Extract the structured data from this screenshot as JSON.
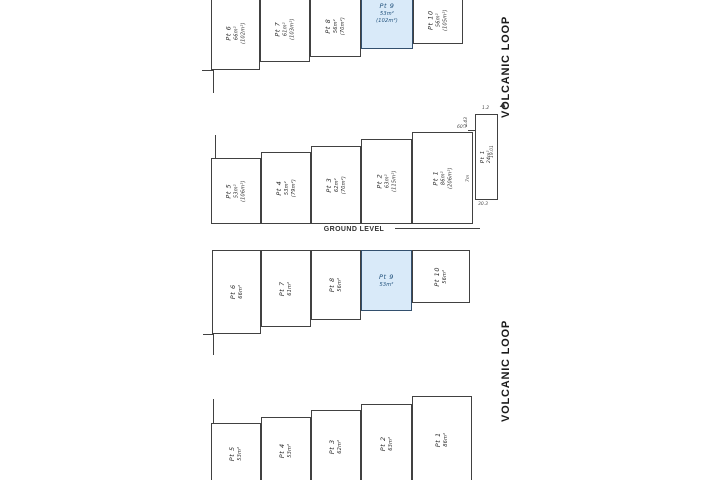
{
  "labels": {
    "street": "VOLCANIC LOOP",
    "ground": "GROUND LEVEL"
  },
  "colors": {
    "highlight_fill": "#d9eaf9",
    "highlight_border": "#33506e",
    "highlight_text": "#1d4e79",
    "line": "#414141"
  },
  "plans": [
    {
      "id": "upper-level-top",
      "lots": [
        {
          "name": "Pt 6",
          "area": "66m²",
          "total": "(102m²)"
        },
        {
          "name": "Pt 7",
          "area": "61m²",
          "total": "(103m²)"
        },
        {
          "name": "Pt 8",
          "area": "56m²",
          "total": "(70m²)"
        },
        {
          "name": "Pt 9",
          "area": "53m²",
          "total": "(102m²)",
          "highlighted": true
        },
        {
          "name": "Pt 10",
          "area": "56m²",
          "total": "(105m²)"
        }
      ]
    },
    {
      "id": "ground-level",
      "lots": [
        {
          "name": "Pt 5",
          "area": "53m²",
          "total": "(106m²)"
        },
        {
          "name": "Pt 4",
          "area": "53m²",
          "total": "(79m²)"
        },
        {
          "name": "Pt 3",
          "area": "62m²",
          "total": "(70m²)"
        },
        {
          "name": "Pt 2",
          "area": "63m²",
          "total": "(115m²)"
        },
        {
          "name": "Pt 1",
          "area": "86m²",
          "total": "(206m²)"
        }
      ],
      "annex": {
        "name": "Pt 1",
        "area": "24m²",
        "dims": [
          "1.2",
          "2.43",
          "60.7",
          "7m",
          "19.01",
          "30.3"
        ]
      }
    },
    {
      "id": "upper-level-bottom",
      "lots": [
        {
          "name": "Pt 6",
          "area": "66m²"
        },
        {
          "name": "Pt 7",
          "area": "61m²"
        },
        {
          "name": "Pt 8",
          "area": "56m²"
        },
        {
          "name": "Pt 9",
          "area": "53m²",
          "highlighted": true
        },
        {
          "name": "Pt 10",
          "area": "56m²"
        }
      ]
    },
    {
      "id": "ground-level-bottom",
      "lots": [
        {
          "name": "Pt 5",
          "area": "53m²"
        },
        {
          "name": "Pt 4",
          "area": "53m²"
        },
        {
          "name": "Pt 3",
          "area": "62m²"
        },
        {
          "name": "Pt 2",
          "area": "63m²"
        },
        {
          "name": "Pt 1",
          "area": "86m²"
        }
      ]
    }
  ]
}
